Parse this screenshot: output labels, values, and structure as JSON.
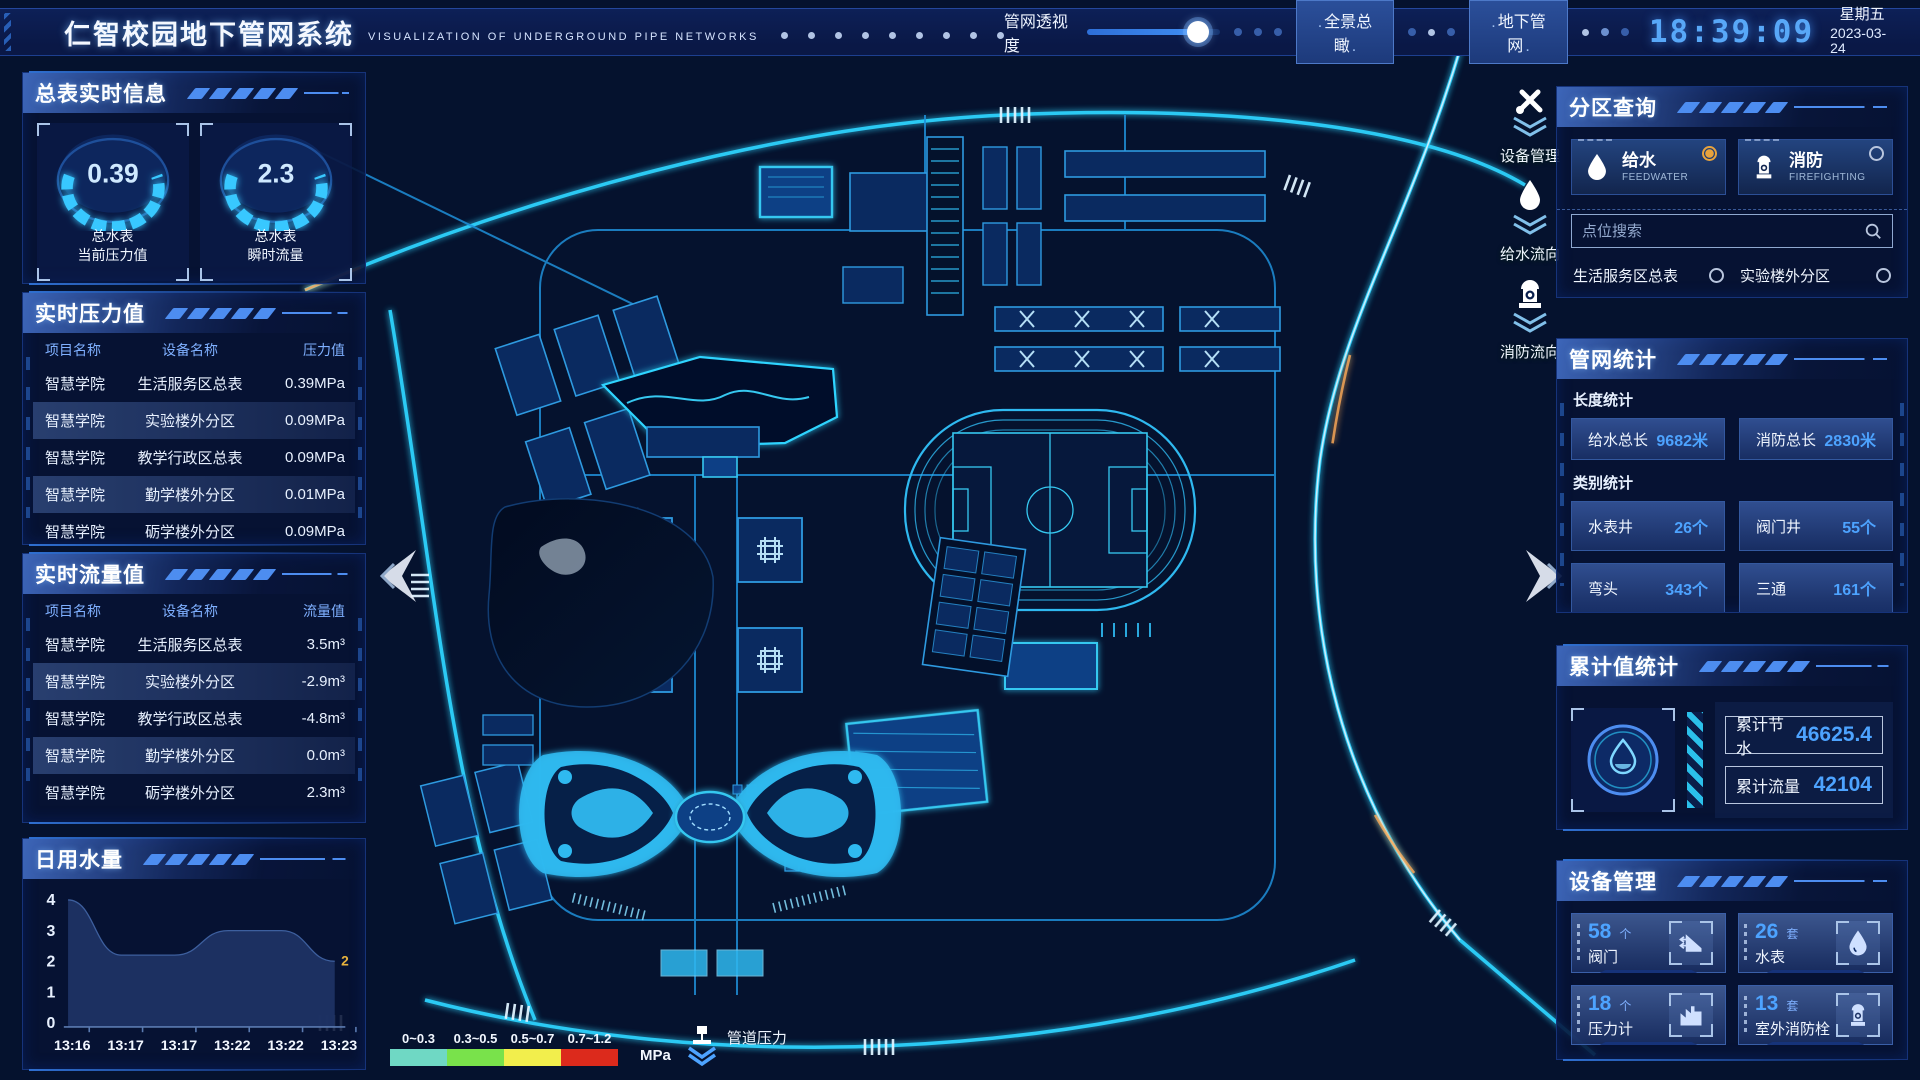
{
  "header": {
    "title": "仁智校园地下管网系统",
    "subtitle": "VISUALIZATION OF UNDERGROUND PIPE NETWORKS",
    "slider_label": "管网透视度",
    "btn_overview": "全景总瞰",
    "btn_underground": "地下管网",
    "time": "18:39:09",
    "weekday": "星期五",
    "date": "2023-03-24"
  },
  "left": {
    "meter_panel": {
      "title": "总表实时信息",
      "gauges": [
        {
          "value": "0.39",
          "label1": "总水表",
          "label2": "当前压力值"
        },
        {
          "value": "2.3",
          "label1": "总水表",
          "label2": "瞬时流量"
        }
      ]
    },
    "pressure_panel": {
      "title": "实时压力值",
      "headers": [
        "项目名称",
        "设备名称",
        "压力值"
      ],
      "rows": [
        [
          "智慧学院",
          "生活服务区总表",
          "0.39MPa"
        ],
        [
          "智慧学院",
          "实验楼外分区",
          "0.09MPa"
        ],
        [
          "智慧学院",
          "教学行政区总表",
          "0.09MPa"
        ],
        [
          "智慧学院",
          "勤学楼外分区",
          "0.01MPa"
        ],
        [
          "智慧学院",
          "砺学楼外分区",
          "0.09MPa"
        ]
      ]
    },
    "flow_panel": {
      "title": "实时流量值",
      "headers": [
        "项目名称",
        "设备名称",
        "流量值"
      ],
      "rows": [
        [
          "智慧学院",
          "生活服务区总表",
          "3.5m³"
        ],
        [
          "智慧学院",
          "实验楼外分区",
          "-2.9m³"
        ],
        [
          "智慧学院",
          "教学行政区总表",
          "-4.8m³"
        ],
        [
          "智慧学院",
          "勤学楼外分区",
          "0.0m³"
        ],
        [
          "智慧学院",
          "砺学楼外分区",
          "2.3m³"
        ]
      ]
    },
    "daily_panel": {
      "title": "日用水量"
    }
  },
  "chart_data": {
    "type": "area",
    "title": "日用水量",
    "x": [
      "13:16",
      "13:17",
      "13:17",
      "13:22",
      "13:22",
      "13:23"
    ],
    "values": [
      4,
      2.2,
      2.2,
      3,
      3,
      2
    ],
    "ylim": [
      0,
      4
    ],
    "yticks": [
      0,
      1,
      2,
      3,
      4
    ],
    "end_label": "2",
    "xlabel": "",
    "ylabel": "",
    "grid": false,
    "area_color": "#1d3364",
    "end_label_color": "#e8b33d"
  },
  "map": {
    "tools": [
      {
        "icon": "wrench-icon",
        "label": "设备管理"
      },
      {
        "icon": "waterdrop-icon",
        "label": "给水流向"
      },
      {
        "icon": "hydrant-icon",
        "label": "消防流向"
      }
    ],
    "legend": {
      "segments": [
        {
          "range": "0~0.3",
          "color": "#6fd8c4"
        },
        {
          "range": "0.3~0.5",
          "color": "#79e24b"
        },
        {
          "range": "0.5~0.7",
          "color": "#f2ee4c"
        },
        {
          "range": "0.7~1.2",
          "color": "#dc2a1c"
        }
      ],
      "unit": "MPa",
      "label": "管道压力"
    }
  },
  "right": {
    "zone_panel": {
      "title": "分区查询",
      "tabs": [
        {
          "label": "给水",
          "sub": "FEEDWATER",
          "active": true
        },
        {
          "label": "消防",
          "sub": "FIREFIGHTING",
          "active": false
        }
      ],
      "search_placeholder": "点位搜索",
      "items": [
        "生活服务区总表",
        "实验楼外分区",
        "教学行政区总表",
        "勤学楼外分区",
        "砺学楼外分区",
        "宿舍区泵房"
      ]
    },
    "stats_panel": {
      "title": "管网统计",
      "length_label": "长度统计",
      "length_stats": [
        {
          "label": "给水总长",
          "value": "9682米"
        },
        {
          "label": "消防总长",
          "value": "2830米"
        }
      ],
      "category_label": "类别统计",
      "category_stats": [
        {
          "label": "水表井",
          "value": "26个"
        },
        {
          "label": "阀门井",
          "value": "55个"
        },
        {
          "label": "弯头",
          "value": "343个"
        },
        {
          "label": "三通",
          "value": "161个"
        }
      ]
    },
    "total_panel": {
      "title": "累计值统计",
      "rows": [
        {
          "label": "累计节水",
          "value": "46625.4"
        },
        {
          "label": "累计流量",
          "value": "42104"
        }
      ]
    },
    "device_panel": {
      "title": "设备管理",
      "cards": [
        {
          "count": "58",
          "unit": "个",
          "label": "阀门",
          "icon": "valve-icon"
        },
        {
          "count": "26",
          "unit": "套",
          "label": "水表",
          "icon": "water-meter-icon"
        },
        {
          "count": "18",
          "unit": "个",
          "label": "压力计",
          "icon": "pressure-gauge-icon"
        },
        {
          "count": "13",
          "unit": "套",
          "label": "室外消防栓",
          "icon": "hydrant-icon"
        }
      ]
    }
  }
}
